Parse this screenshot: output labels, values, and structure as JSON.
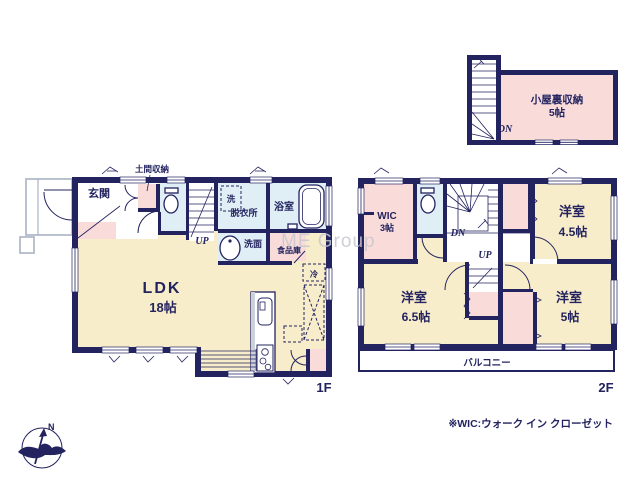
{
  "colors": {
    "wall": "#232360",
    "cream": "#f8edca",
    "pink": "#f9dcda",
    "blue": "#e0eef6",
    "white": "#ffffff",
    "watermark_gray": "#c7c7cf",
    "light_outline": "#a8b2c4"
  },
  "floor1": {
    "label": "1F",
    "genkan": "玄関",
    "doma_storage": "土間収納",
    "washer": "洗",
    "dressing": "脱衣所",
    "bath": "浴室",
    "washstand": "洗面",
    "pantry": "食品庫",
    "fridge": "冷",
    "stairs_up": "UP",
    "ldk": "LDK",
    "ldk_size": "18帖"
  },
  "floor2": {
    "label": "2F",
    "wic": "WIC",
    "wic_size": "3帖",
    "stairs_down": "DN",
    "stairs_up": "UP",
    "bedroom_a": "洋室",
    "bedroom_a_size": "4.5帖",
    "bedroom_b": "洋室",
    "bedroom_b_size": "6.5帖",
    "bedroom_c": "洋室",
    "bedroom_c_size": "5帖",
    "balcony": "バルコニー"
  },
  "attic": {
    "name": "小屋裏収納",
    "size": "5帖",
    "stairs_down": "DN"
  },
  "compass": {
    "north": "N"
  },
  "watermark": "ME Group",
  "footnote": "※WIC:ウォーク イン クローゼット"
}
